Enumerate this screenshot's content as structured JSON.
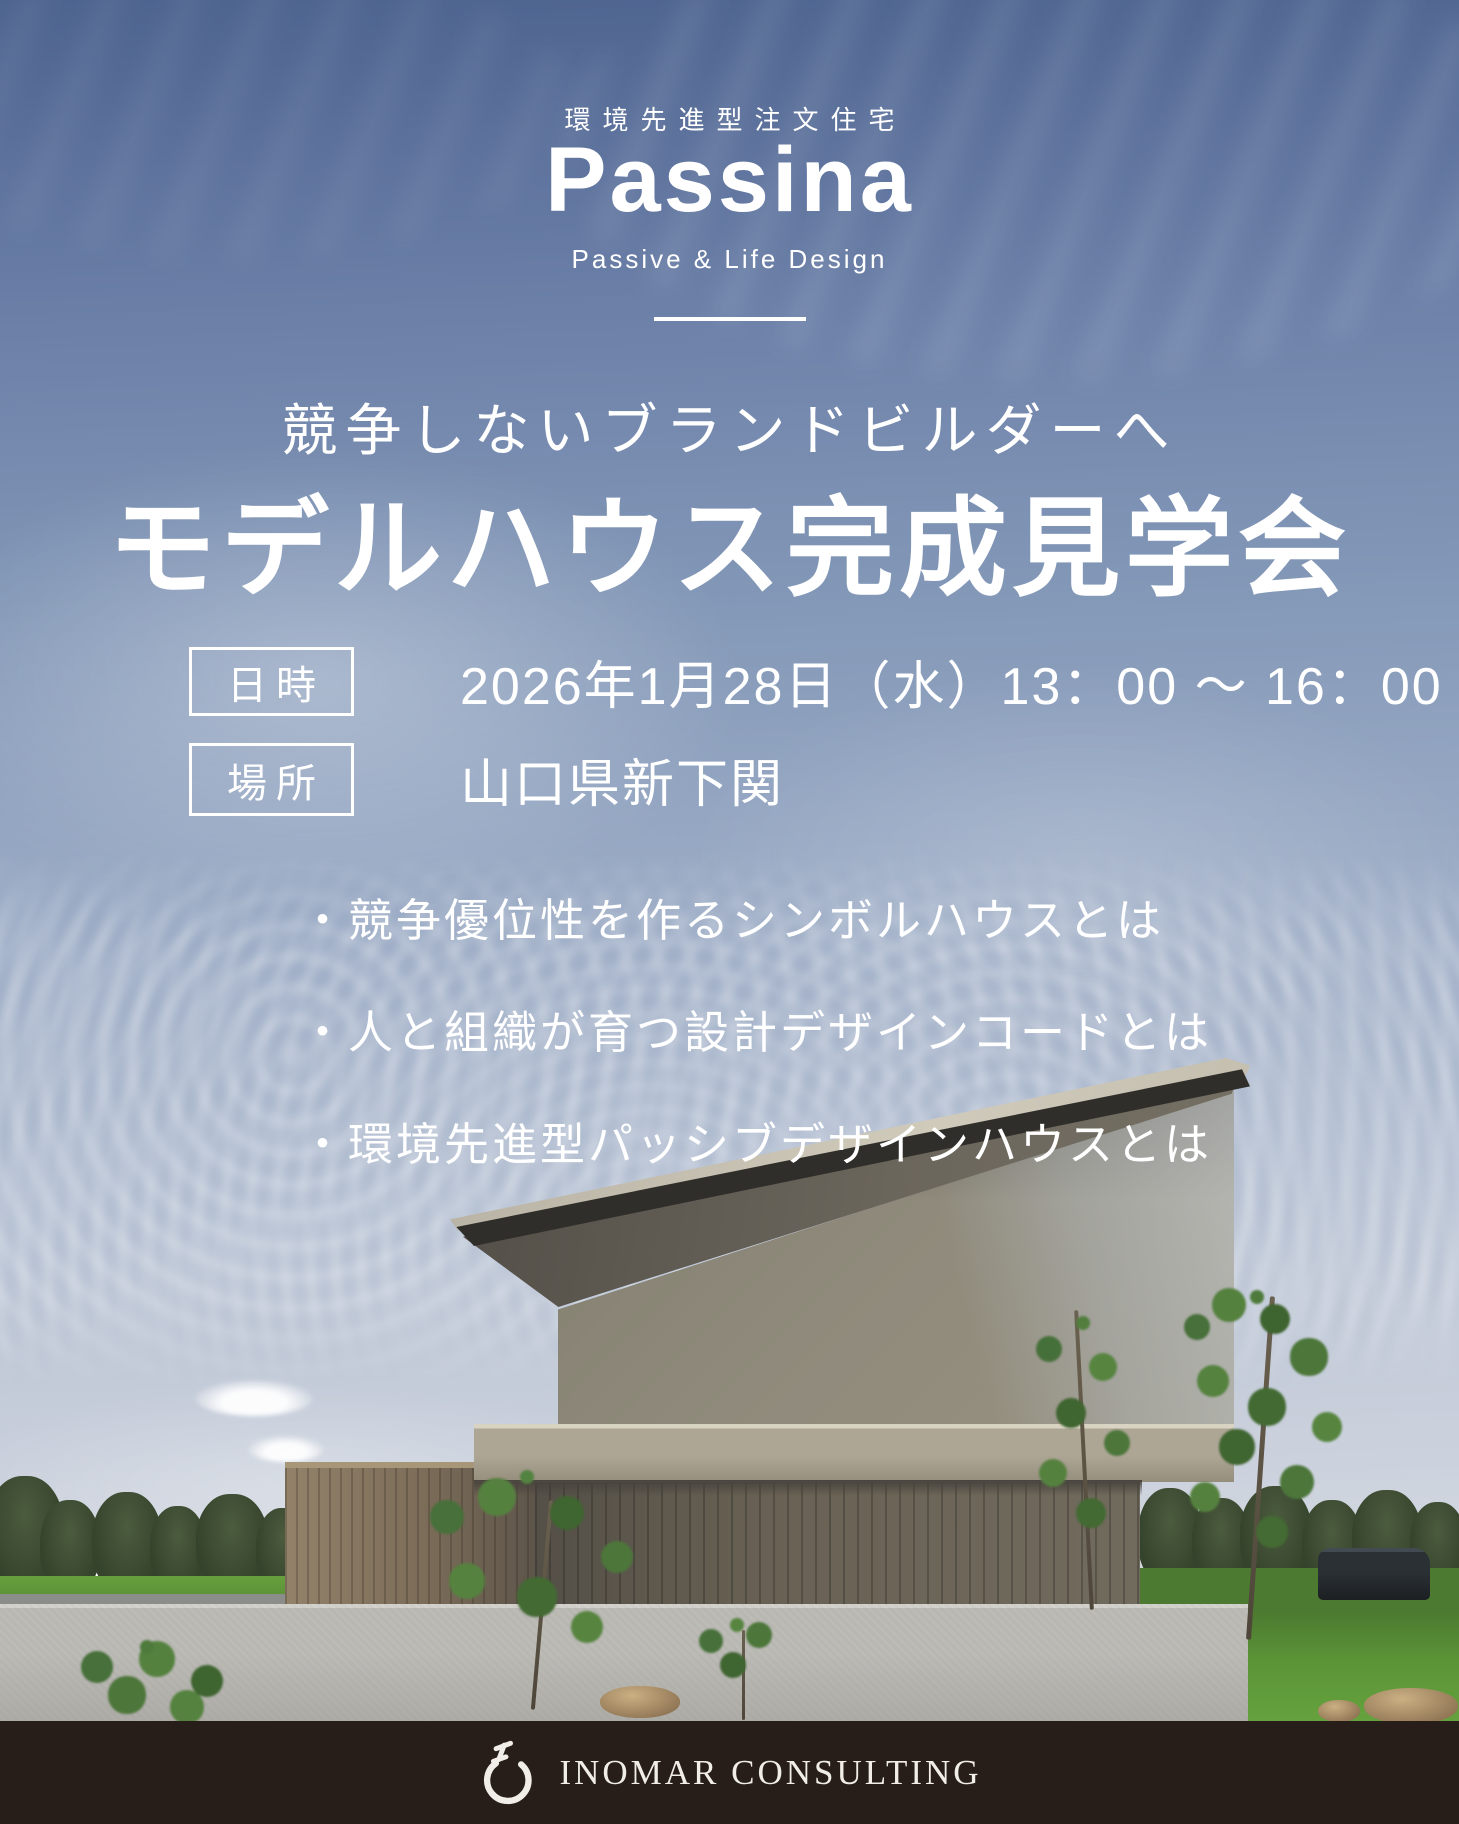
{
  "brand": {
    "tagline": "環境先進型注文住宅",
    "logo": "Passina",
    "sub": "Passive & Life Design"
  },
  "hero": {
    "subtitle": "競争しないブランドビルダーへ",
    "title": "モデルハウス完成見学会"
  },
  "details": [
    {
      "label": "日時",
      "value": "2026年1月28日（水）13：00 ～ 16：00"
    },
    {
      "label": "場所",
      "value": "山口県新下関"
    }
  ],
  "bullets": [
    "・競争優位性を作るシンボルハウスとは",
    "・人と組織が育つ設計デザインコードとは",
    "・環境先進型パッシブデザインハウスとは"
  ],
  "footer": {
    "company": "INOMAR CONSULTING",
    "logo_icon": "inomar-ring-icon"
  },
  "colors": {
    "text": "#ffffff",
    "footer_bg": "#281e19",
    "sky_top": "#4d648f",
    "facade": "#8f8a7b",
    "wood_dark": "#696254",
    "wood_light": "#93826a",
    "fence": "#bcbbb6"
  }
}
